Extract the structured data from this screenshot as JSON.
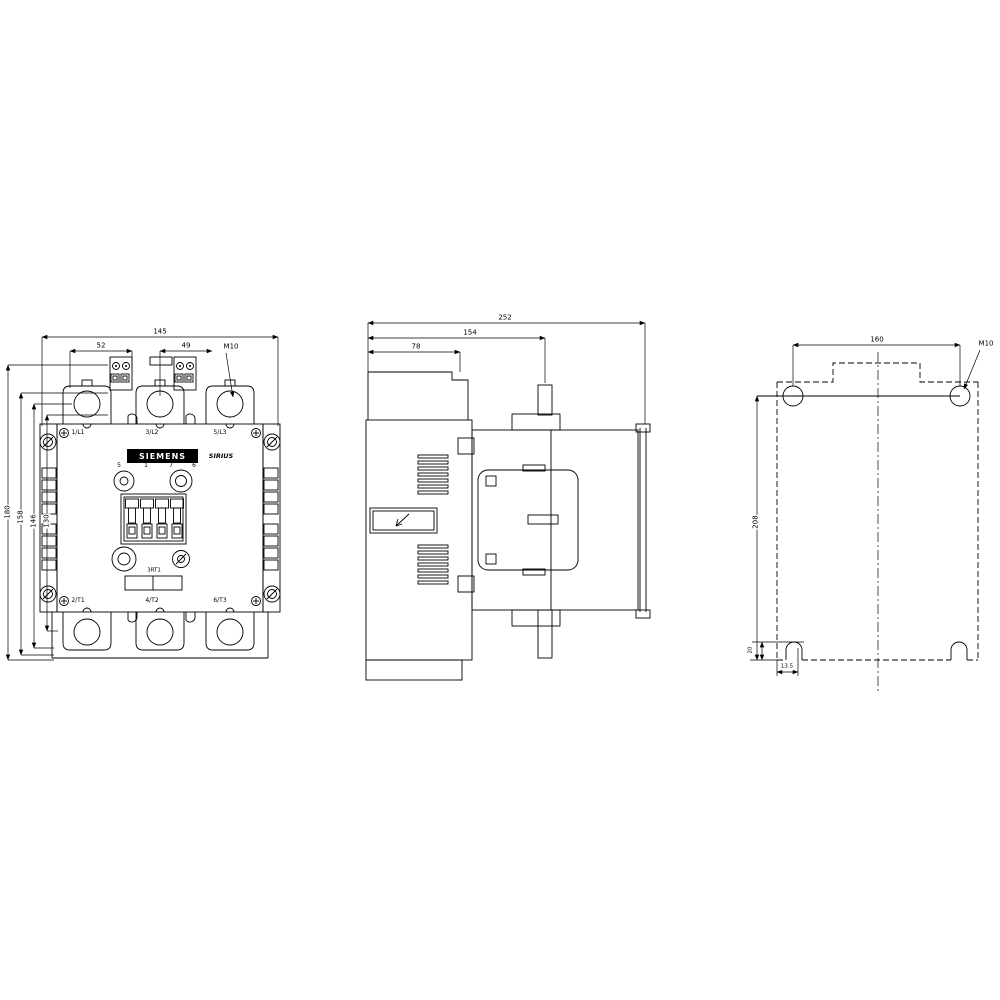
{
  "background": "#ffffff",
  "line_color": "#000000",
  "front_view": {
    "dims": {
      "total_width": "145",
      "left_spacing": "52",
      "right_spacing": "49",
      "terminal_screw": "M10",
      "heights": [
        "180",
        "158",
        "146",
        "130"
      ]
    },
    "terminals_top": [
      "1/L1",
      "3/L2",
      "5/L3"
    ],
    "terminals_bottom": [
      "2/T1",
      "4/T2",
      "6/T3"
    ],
    "brand": "SIEMENS",
    "series": "SIRIUS",
    "type_code": "3RT1",
    "coil_terminals": [
      "5",
      "1",
      "7",
      "6"
    ]
  },
  "side_view": {
    "dims": {
      "total_depth": "252",
      "mid_depth": "154",
      "front_depth": "78"
    }
  },
  "rear_view": {
    "dims": {
      "hole_spacing_width": "160",
      "hole_spacing_height": "208",
      "mounting_screw": "M10",
      "slot_height": "20",
      "slot_offset": "13.5"
    }
  }
}
